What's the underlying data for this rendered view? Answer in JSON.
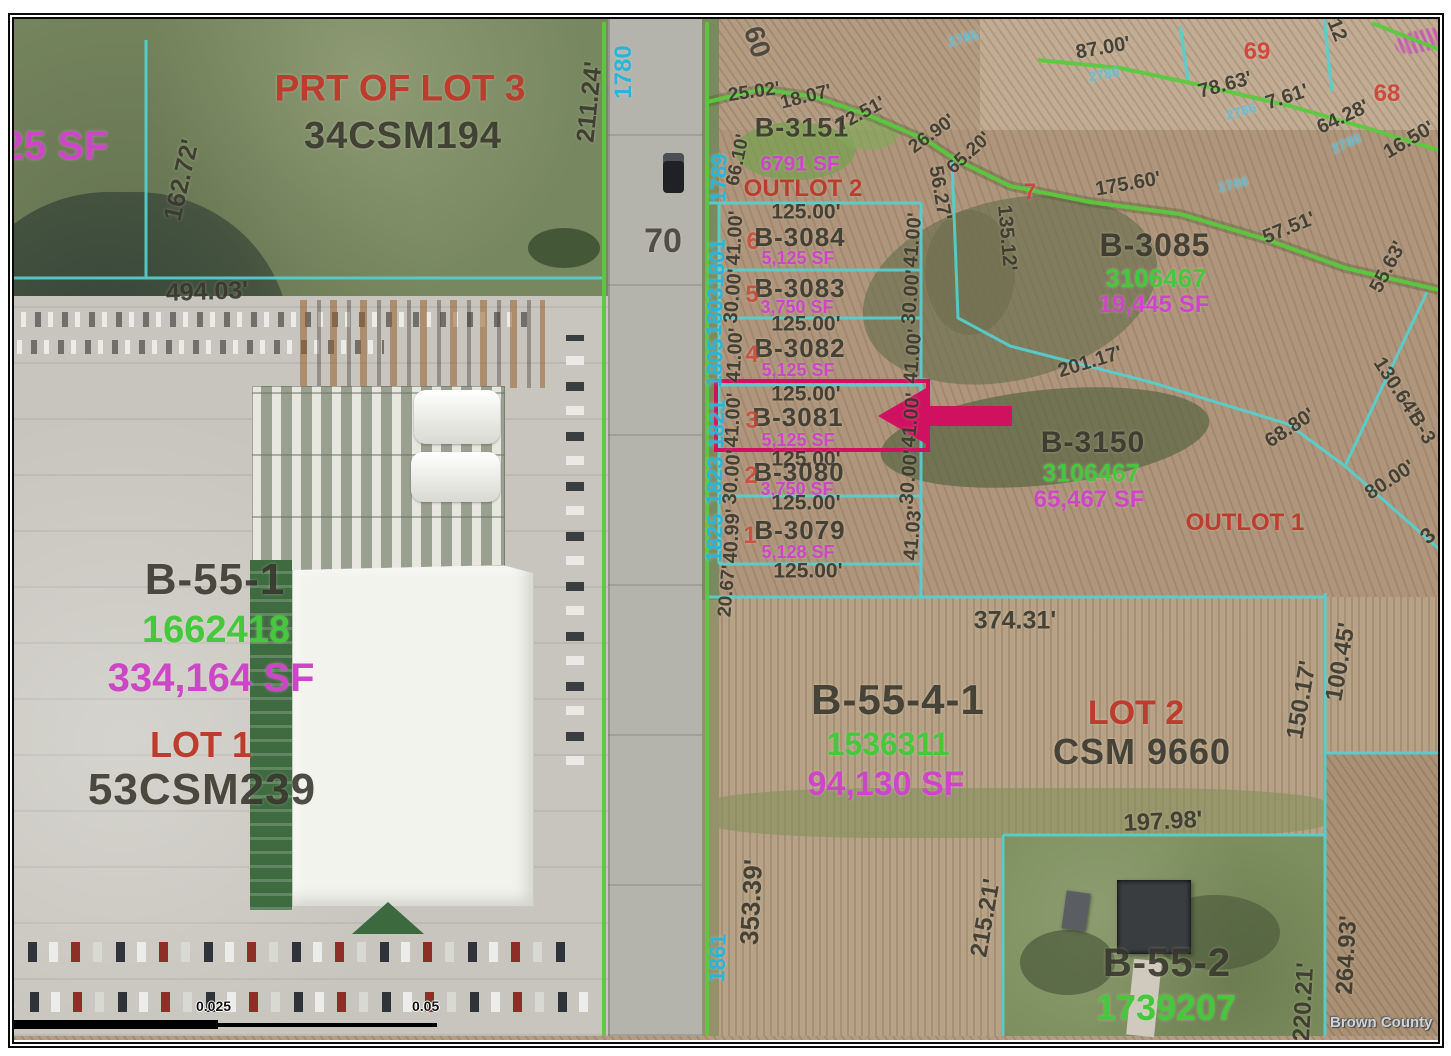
{
  "map": {
    "colors": {
      "highlight": "#d01160",
      "parcel_line": "#55d0cf",
      "boundary_line": "#5bc93d",
      "address_text": "#2ab4d9",
      "apn_text": "#46c83c",
      "area_text": "#cd46c8",
      "lot_text": "#bc3c2d"
    },
    "watermark": "Brown County",
    "scalebar": {
      "tick0": "0",
      "tick1": "0.025",
      "tick2": "0.05"
    },
    "road": {
      "route_number": "70",
      "width_label": "60"
    },
    "highlighted_parcel": "B-3081",
    "labels": [
      {
        "t": "25 SF",
        "x": 55,
        "y": 146,
        "r": 0,
        "s": 40,
        "c": "sf"
      },
      {
        "t": "PRT OF LOT 3",
        "x": 400,
        "y": 88,
        "r": 0,
        "s": 37,
        "c": "lotred"
      },
      {
        "t": "34CSM194",
        "x": 403,
        "y": 136,
        "r": 0,
        "s": 38,
        "c": "parcel"
      },
      {
        "t": "162.72'",
        "x": 182,
        "y": 180,
        "r": -77,
        "s": 25,
        "c": "dim"
      },
      {
        "t": "494.03'",
        "x": 207,
        "y": 292,
        "r": -2,
        "s": 25,
        "c": "dim"
      },
      {
        "t": "211.24'",
        "x": 590,
        "y": 102,
        "r": -84,
        "s": 25,
        "c": "dim"
      },
      {
        "t": "1780",
        "x": 624,
        "y": 72,
        "r": -90,
        "s": 24,
        "c": "addr"
      },
      {
        "t": "70",
        "x": 663,
        "y": 241,
        "r": 0,
        "s": 34,
        "c": "road-lbl"
      },
      {
        "t": "60",
        "x": 757,
        "y": 42,
        "r": 72,
        "s": 28,
        "c": "road-lbl"
      },
      {
        "t": "1789",
        "x": 719,
        "y": 178,
        "r": -88,
        "s": 22,
        "c": "addr"
      },
      {
        "t": "1801",
        "x": 717,
        "y": 263,
        "r": -88,
        "s": 22,
        "c": "addr"
      },
      {
        "t": "1803",
        "x": 715,
        "y": 312,
        "r": -88,
        "s": 22,
        "c": "addr"
      },
      {
        "t": "1805",
        "x": 715,
        "y": 363,
        "r": -88,
        "s": 22,
        "c": "addr"
      },
      {
        "t": "1821",
        "x": 717,
        "y": 424,
        "r": -88,
        "s": 22,
        "c": "addr"
      },
      {
        "t": "1823",
        "x": 715,
        "y": 481,
        "r": -88,
        "s": 22,
        "c": "addr"
      },
      {
        "t": "1825",
        "x": 715,
        "y": 538,
        "r": -88,
        "s": 22,
        "c": "addr"
      },
      {
        "t": "1861",
        "x": 718,
        "y": 958,
        "r": -88,
        "s": 22,
        "c": "addr"
      },
      {
        "t": "25.02'",
        "x": 754,
        "y": 92,
        "r": -8,
        "s": 19,
        "c": "dim"
      },
      {
        "t": "18.07'",
        "x": 806,
        "y": 97,
        "r": -14,
        "s": 19,
        "c": "dim"
      },
      {
        "t": "72.51'",
        "x": 861,
        "y": 114,
        "r": -28,
        "s": 19,
        "c": "dim"
      },
      {
        "t": "26.90'",
        "x": 932,
        "y": 134,
        "r": -36,
        "s": 19,
        "c": "dim"
      },
      {
        "t": "65.20'",
        "x": 969,
        "y": 153,
        "r": -42,
        "s": 19,
        "c": "dim"
      },
      {
        "t": "66.10'",
        "x": 738,
        "y": 160,
        "r": -78,
        "s": 19,
        "c": "dim"
      },
      {
        "t": "B-3151",
        "x": 802,
        "y": 128,
        "r": 0,
        "s": 27,
        "c": "parcel"
      },
      {
        "t": "6791 SF",
        "x": 800,
        "y": 164,
        "r": 0,
        "s": 21,
        "c": "sf"
      },
      {
        "t": "OUTLOT 2",
        "x": 803,
        "y": 189,
        "r": 0,
        "s": 24,
        "c": "lotred"
      },
      {
        "t": "125.00'",
        "x": 806,
        "y": 212,
        "r": 0,
        "s": 21,
        "c": "dim"
      },
      {
        "t": "6",
        "x": 753,
        "y": 242,
        "r": 0,
        "s": 24,
        "c": "lotnum"
      },
      {
        "t": "B-3084",
        "x": 800,
        "y": 237,
        "r": 0,
        "s": 26,
        "c": "parcel"
      },
      {
        "t": "5,125 SF",
        "x": 798,
        "y": 258,
        "r": 0,
        "s": 18,
        "c": "sf"
      },
      {
        "t": "41.00'",
        "x": 735,
        "y": 238,
        "r": -87,
        "s": 20,
        "c": "dim"
      },
      {
        "t": "41.00'",
        "x": 913,
        "y": 240,
        "r": -85,
        "s": 20,
        "c": "dim"
      },
      {
        "t": "B-3083",
        "x": 800,
        "y": 288,
        "r": 0,
        "s": 26,
        "c": "parcel"
      },
      {
        "t": "5",
        "x": 752,
        "y": 295,
        "r": 0,
        "s": 24,
        "c": "lotnum"
      },
      {
        "t": "3,750 SF",
        "x": 797,
        "y": 307,
        "r": 0,
        "s": 18,
        "c": "sf"
      },
      {
        "t": "30.00'",
        "x": 733,
        "y": 296,
        "r": -85,
        "s": 20,
        "c": "dim"
      },
      {
        "t": "30.00'",
        "x": 911,
        "y": 297,
        "r": -85,
        "s": 20,
        "c": "dim"
      },
      {
        "t": "125.00'",
        "x": 806,
        "y": 324,
        "r": 0,
        "s": 21,
        "c": "dim"
      },
      {
        "t": "B-3082",
        "x": 800,
        "y": 348,
        "r": 0,
        "s": 26,
        "c": "parcel"
      },
      {
        "t": "4",
        "x": 752,
        "y": 355,
        "r": 0,
        "s": 24,
        "c": "lotnum"
      },
      {
        "t": "5,125 SF",
        "x": 798,
        "y": 370,
        "r": 0,
        "s": 18,
        "c": "sf"
      },
      {
        "t": "41.00'",
        "x": 735,
        "y": 355,
        "r": -87,
        "s": 20,
        "c": "dim"
      },
      {
        "t": "41.00'",
        "x": 913,
        "y": 356,
        "r": -85,
        "s": 20,
        "c": "dim"
      },
      {
        "t": "125.00'",
        "x": 806,
        "y": 394,
        "r": 0,
        "s": 21,
        "c": "dim"
      },
      {
        "t": "B-3081",
        "x": 798,
        "y": 417,
        "r": 0,
        "s": 26,
        "c": "parcel"
      },
      {
        "t": "3",
        "x": 752,
        "y": 421,
        "r": 0,
        "s": 24,
        "c": "lotnum"
      },
      {
        "t": "5,125 SF",
        "x": 798,
        "y": 440,
        "r": 0,
        "s": 18,
        "c": "sf"
      },
      {
        "t": "41.00'",
        "x": 733,
        "y": 420,
        "r": -87,
        "s": 20,
        "c": "dim"
      },
      {
        "t": "41.00'",
        "x": 911,
        "y": 420,
        "r": -85,
        "s": 20,
        "c": "dim"
      },
      {
        "t": "125.00'",
        "x": 806,
        "y": 459,
        "r": 0,
        "s": 21,
        "c": "dim"
      },
      {
        "t": "B-3080",
        "x": 799,
        "y": 472,
        "r": 0,
        "s": 26,
        "c": "parcel"
      },
      {
        "t": "2",
        "x": 751,
        "y": 476,
        "r": 0,
        "s": 24,
        "c": "lotnum"
      },
      {
        "t": "3,750 SF",
        "x": 797,
        "y": 489,
        "r": 0,
        "s": 18,
        "c": "sf"
      },
      {
        "t": "30.00'",
        "x": 732,
        "y": 477,
        "r": -85,
        "s": 20,
        "c": "dim"
      },
      {
        "t": "30.00'",
        "x": 909,
        "y": 477,
        "r": -85,
        "s": 20,
        "c": "dim"
      },
      {
        "t": "125.00'",
        "x": 806,
        "y": 503,
        "r": 0,
        "s": 21,
        "c": "dim"
      },
      {
        "t": "B-3079",
        "x": 800,
        "y": 530,
        "r": 0,
        "s": 26,
        "c": "parcel"
      },
      {
        "t": "1",
        "x": 750,
        "y": 536,
        "r": 0,
        "s": 24,
        "c": "lotnum"
      },
      {
        "t": "5,128 SF",
        "x": 798,
        "y": 552,
        "r": 0,
        "s": 18,
        "c": "sf"
      },
      {
        "t": "40.99'",
        "x": 732,
        "y": 536,
        "r": -87,
        "s": 20,
        "c": "dim"
      },
      {
        "t": "41.03'",
        "x": 913,
        "y": 533,
        "r": -85,
        "s": 20,
        "c": "dim"
      },
      {
        "t": "125.00'",
        "x": 808,
        "y": 571,
        "r": 0,
        "s": 21,
        "c": "dim"
      },
      {
        "t": "20.67'",
        "x": 727,
        "y": 591,
        "r": -85,
        "s": 19,
        "c": "dim"
      },
      {
        "t": "56.27'",
        "x": 940,
        "y": 193,
        "r": 80,
        "s": 20,
        "c": "dim"
      },
      {
        "t": "135.12'",
        "x": 1007,
        "y": 238,
        "r": 85,
        "s": 20,
        "c": "dim"
      },
      {
        "t": "87.00'",
        "x": 1103,
        "y": 48,
        "r": -10,
        "s": 20,
        "c": "dim"
      },
      {
        "t": "69",
        "x": 1257,
        "y": 52,
        "r": 0,
        "s": 24,
        "c": "redtag"
      },
      {
        "t": "78.63'",
        "x": 1225,
        "y": 85,
        "r": -15,
        "s": 20,
        "c": "dim"
      },
      {
        "t": "7.61'",
        "x": 1287,
        "y": 97,
        "r": -18,
        "s": 20,
        "c": "dim"
      },
      {
        "t": "64.28'",
        "x": 1343,
        "y": 117,
        "r": -25,
        "s": 20,
        "c": "dim"
      },
      {
        "t": "16.50'",
        "x": 1409,
        "y": 140,
        "r": -30,
        "s": 20,
        "c": "dim"
      },
      {
        "t": "68",
        "x": 1387,
        "y": 94,
        "r": 0,
        "s": 24,
        "c": "redtag"
      },
      {
        "t": "12",
        "x": 1337,
        "y": 30,
        "r": 68,
        "s": 20,
        "c": "dim"
      },
      {
        "t": "2786",
        "x": 963,
        "y": 38,
        "r": -15,
        "s": 14,
        "c": "cyantag"
      },
      {
        "t": "2786",
        "x": 1104,
        "y": 74,
        "r": -10,
        "s": 14,
        "c": "cyantag"
      },
      {
        "t": "2786",
        "x": 1241,
        "y": 111,
        "r": -16,
        "s": 14,
        "c": "cyantag"
      },
      {
        "t": "2786",
        "x": 1346,
        "y": 143,
        "r": -24,
        "s": 14,
        "c": "cyantag"
      },
      {
        "t": "2786",
        "x": 1233,
        "y": 184,
        "r": -14,
        "s": 14,
        "c": "cyantag"
      },
      {
        "t": "175.60'",
        "x": 1128,
        "y": 184,
        "r": -10,
        "s": 20,
        "c": "dim"
      },
      {
        "t": "57.51'",
        "x": 1289,
        "y": 228,
        "r": -22,
        "s": 20,
        "c": "dim"
      },
      {
        "t": "55.63'",
        "x": 1388,
        "y": 267,
        "r": -62,
        "s": 20,
        "c": "dim"
      },
      {
        "t": "7",
        "x": 1030,
        "y": 192,
        "r": 0,
        "s": 22,
        "c": "redtag"
      },
      {
        "t": "B-3085",
        "x": 1155,
        "y": 245,
        "r": 0,
        "s": 32,
        "c": "parcel"
      },
      {
        "t": "3106467",
        "x": 1156,
        "y": 278,
        "r": 0,
        "s": 26,
        "c": "apn"
      },
      {
        "t": "19,445 SF",
        "x": 1154,
        "y": 305,
        "r": 0,
        "s": 24,
        "c": "sf"
      },
      {
        "t": "201.17'",
        "x": 1090,
        "y": 362,
        "r": -17,
        "s": 20,
        "c": "dim"
      },
      {
        "t": "B-3150",
        "x": 1093,
        "y": 443,
        "r": 0,
        "s": 30,
        "c": "parcel"
      },
      {
        "t": "3106467",
        "x": 1091,
        "y": 474,
        "r": 0,
        "s": 25,
        "c": "apn"
      },
      {
        "t": "65,467 SF",
        "x": 1089,
        "y": 500,
        "r": 0,
        "s": 24,
        "c": "sf"
      },
      {
        "t": "OUTLOT 1",
        "x": 1245,
        "y": 523,
        "r": 0,
        "s": 24,
        "c": "lotred"
      },
      {
        "t": "68.80'",
        "x": 1290,
        "y": 428,
        "r": -33,
        "s": 20,
        "c": "dim"
      },
      {
        "t": "130.64'",
        "x": 1396,
        "y": 387,
        "r": 57,
        "s": 20,
        "c": "dim"
      },
      {
        "t": "B-3",
        "x": 1422,
        "y": 428,
        "r": 60,
        "s": 20,
        "c": "parcel"
      },
      {
        "t": "80.00'",
        "x": 1390,
        "y": 480,
        "r": -33,
        "s": 20,
        "c": "dim"
      },
      {
        "t": "3",
        "x": 1428,
        "y": 536,
        "r": -40,
        "s": 22,
        "c": "dim"
      },
      {
        "t": "374.31'",
        "x": 1015,
        "y": 621,
        "r": 0,
        "s": 25,
        "c": "dim"
      },
      {
        "t": "B-55-4-1",
        "x": 898,
        "y": 700,
        "r": 0,
        "s": 42,
        "c": "parcel"
      },
      {
        "t": "1536311",
        "x": 888,
        "y": 744,
        "r": 0,
        "s": 32,
        "c": "apn"
      },
      {
        "t": "94,130 SF",
        "x": 886,
        "y": 784,
        "r": 0,
        "s": 34,
        "c": "sf"
      },
      {
        "t": "LOT 2",
        "x": 1136,
        "y": 713,
        "r": 0,
        "s": 34,
        "c": "lotred"
      },
      {
        "t": "CSM 9660",
        "x": 1142,
        "y": 752,
        "r": 0,
        "s": 36,
        "c": "parcel"
      },
      {
        "t": "100.45'",
        "x": 1341,
        "y": 662,
        "r": -80,
        "s": 24,
        "c": "dim"
      },
      {
        "t": "150.17'",
        "x": 1302,
        "y": 700,
        "r": -80,
        "s": 24,
        "c": "dim"
      },
      {
        "t": "197.98'",
        "x": 1163,
        "y": 822,
        "r": -3,
        "s": 24,
        "c": "dim"
      },
      {
        "t": "353.39'",
        "x": 751,
        "y": 902,
        "r": -87,
        "s": 26,
        "c": "dim"
      },
      {
        "t": "215.21'",
        "x": 986,
        "y": 918,
        "r": -80,
        "s": 24,
        "c": "dim"
      },
      {
        "t": "264.93'",
        "x": 1347,
        "y": 955,
        "r": -87,
        "s": 24,
        "c": "dim"
      },
      {
        "t": "220.21'",
        "x": 1304,
        "y": 1002,
        "r": -87,
        "s": 24,
        "c": "dim"
      },
      {
        "t": "B-55-2",
        "x": 1167,
        "y": 963,
        "r": 0,
        "s": 40,
        "c": "parcel"
      },
      {
        "t": "1739207",
        "x": 1166,
        "y": 1008,
        "r": 0,
        "s": 36,
        "c": "apn"
      },
      {
        "t": "B-55-1",
        "x": 215,
        "y": 580,
        "r": 0,
        "s": 44,
        "c": "parcel"
      },
      {
        "t": "1662418",
        "x": 216,
        "y": 630,
        "r": 0,
        "s": 38,
        "c": "apn"
      },
      {
        "t": "334,164 SF",
        "x": 211,
        "y": 678,
        "r": 0,
        "s": 40,
        "c": "sf"
      },
      {
        "t": "LOT 1",
        "x": 201,
        "y": 745,
        "r": 0,
        "s": 36,
        "c": "lotred"
      },
      {
        "t": "53CSM239",
        "x": 202,
        "y": 790,
        "r": 0,
        "s": 44,
        "c": "parcel"
      }
    ]
  }
}
